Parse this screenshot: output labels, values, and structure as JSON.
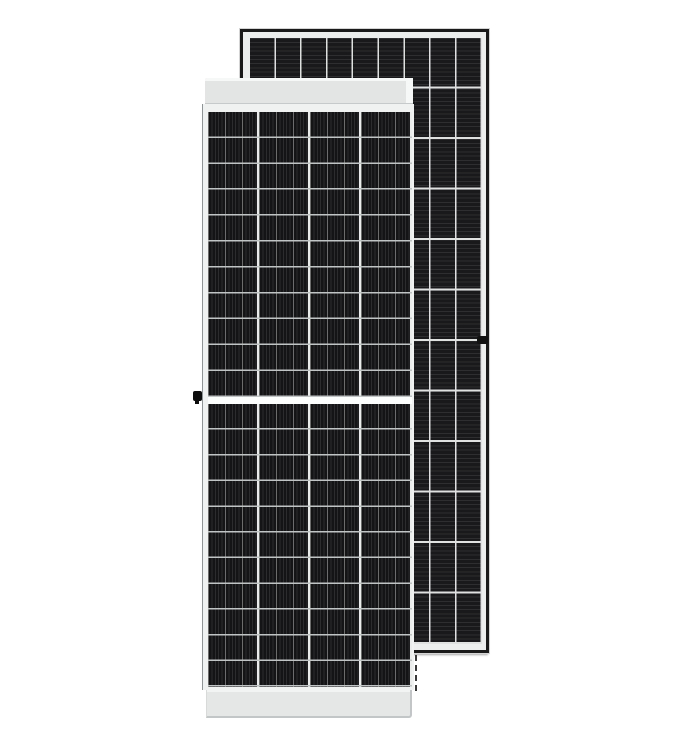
{
  "scene": {
    "width": 684,
    "height": 748,
    "background": "#ffffff"
  },
  "back_panel": {
    "label": "rear solar panel, portrait, black frame",
    "left": 240,
    "top": 29,
    "width": 249,
    "height": 624,
    "frame_color": "#191919",
    "outer_highlight": "#d4d4d4",
    "margin_color": "#eceded",
    "padding": "6px 4px 6px 7px",
    "cells": {
      "cols": 9,
      "rows": 12,
      "col_pitch": "25.8px",
      "row_pitch": "50.5px",
      "stripe_pitch": "4.2px",
      "base_color": "#19191b",
      "stripe_color": "rgba(255,255,255,0.09)",
      "separator_color": "#dfe0e0"
    }
  },
  "front_panel": {
    "label": "front solar panel, white frame, half-cut cells",
    "left": 202,
    "top": 78,
    "width": 212,
    "height": 640,
    "top_band": {
      "left": 3,
      "top": 0,
      "width": 208,
      "height": 26,
      "color": "#e3e5e5",
      "highlight": "#f6f7f7",
      "edge_color": "#c6caca"
    },
    "face": {
      "top": 26,
      "height": 586,
      "color": "#f0f1f1",
      "frame_line_color": "#8f9494"
    },
    "cells_upper": {
      "left": 6,
      "top": 34,
      "width": 204,
      "height": 285,
      "row_pitch": "25.9px"
    },
    "mid_gap": {
      "left": 6,
      "top": 319,
      "width": 204,
      "height": 7,
      "color": "#fcfdfd"
    },
    "cells_lower": {
      "left": 6,
      "top": 326,
      "width": 204,
      "height": 283,
      "row_pitch": "25.7px"
    },
    "cells_style": {
      "cols": 4,
      "col_pitch": "51px",
      "stripe_pitch": "3.4px",
      "busbar_pitch": "17px",
      "base_color": "#141416",
      "stripe_color": "rgba(255,255,255,0.10)",
      "busbar_color": "rgba(255,255,255,0.30)",
      "row_separator_color": "#c0c4c4",
      "col_separator_color": "#eaebeb"
    },
    "bottom_band": {
      "left": 4,
      "top": 612,
      "width": 206,
      "height": 28,
      "color": "#e5e7e7",
      "edge_color": "#c2c6c6"
    }
  },
  "details": {
    "left_mid_clip": {
      "left": 193,
      "top": 391,
      "width": 9,
      "height": 10,
      "color": "#0d0d0d"
    },
    "right_mid_clip": {
      "left": 477,
      "top": 336,
      "width": 11,
      "height": 8,
      "color": "#111111"
    },
    "hidden_edge_dashes": {
      "left": 415,
      "top": 655,
      "height": 36,
      "color": "#3a3a3a"
    }
  }
}
